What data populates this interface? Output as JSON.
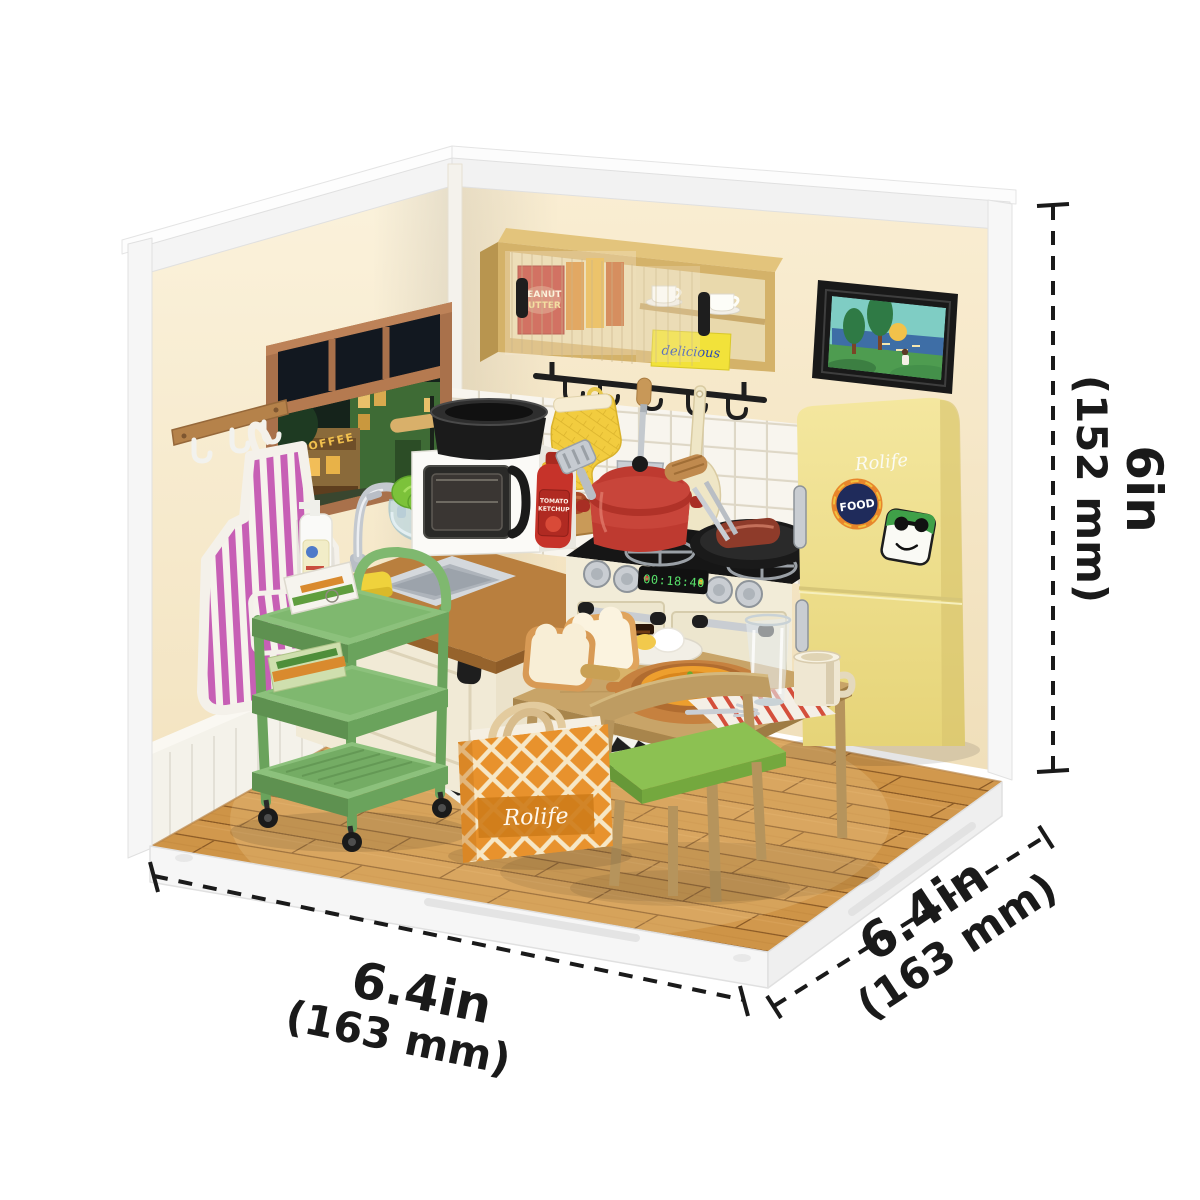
{
  "product": {
    "brand": "Rolife",
    "kit_type": "DIY miniature corner-room kitchen kit",
    "dimensions": {
      "height": {
        "value": "6in",
        "metric": "(152 mm)"
      },
      "width": {
        "value": "6.4in",
        "metric": "(163 mm)"
      },
      "depth": {
        "value": "6.4in",
        "metric": "(163 mm)"
      }
    }
  },
  "scene": {
    "fridge": {
      "logo": "Rolife",
      "magnet_label": "FOOD"
    },
    "bag": {
      "logo": "Rolife"
    },
    "stove": {
      "display_time": "00:18:40"
    },
    "cabinet": {
      "jar_line1": "PEANUT",
      "jar_line2": "BUTTER",
      "box_script": "delicious"
    },
    "window": {
      "shop_sign": "COFFEE"
    },
    "ketchup": {
      "line1": "TOMATO",
      "line2": "KETCHUP"
    }
  },
  "colors": {
    "wall_cream": "#F8ECD2",
    "frame_white": "#F5F5F5",
    "floor_wood": "#D89C4C",
    "fridge_yellow": "#EFE08E",
    "cart_green": "#7FB86F",
    "pot_red": "#C0392E",
    "bag_orange": "#E8922D",
    "cabinet_tan": "#D4B269",
    "annotation_black": "#1A1A1A"
  }
}
